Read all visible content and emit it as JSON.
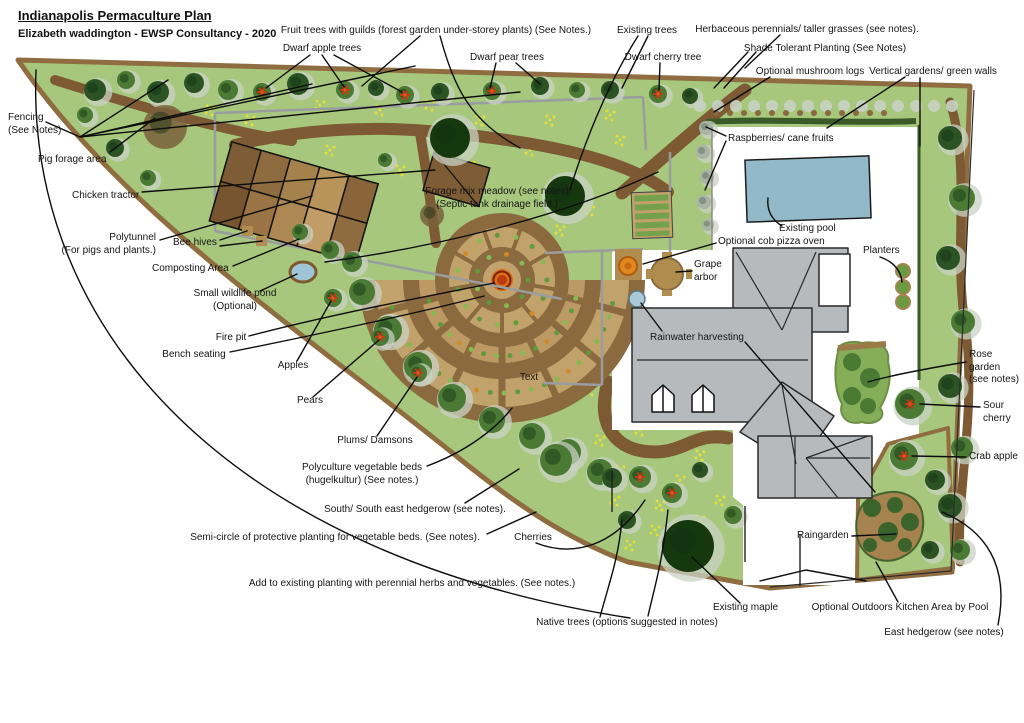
{
  "meta": {
    "title": "Indianapolis Permaculture Plan",
    "subtitle": "Elizabeth waddington - EWSP Consultancy - 2020"
  },
  "colors": {
    "grass": "#a6c77c",
    "meadow_flower": "#e6df38",
    "path_brown": "#7d5a33",
    "boundary_tan": "#8f6d40",
    "pool_blue": "#92b9c7",
    "house_gray": "#b7babd",
    "bed_tan": "#c2a26b",
    "ring_brown": "#8a6a3e",
    "fire_orange": "#d97014",
    "fire_red": "#bb3a0e",
    "tree_dark": "#2b5323",
    "tree_mid": "#4a7a33",
    "maple_green": "#16380f",
    "fluff_gray": "#c9d2c4",
    "fence_gray": "#9a9da0",
    "oven_orange": "#e08a20",
    "water_blue": "#9fc6d6",
    "marker_red": "#c23b12"
  },
  "labels": [
    {
      "id": "fruit-trees-guilds",
      "text": "Fruit trees with guilds (forest garden under-storey plants) (See Notes.)",
      "x": 436,
      "y": 31,
      "align": "c"
    },
    {
      "id": "dwarf-apple-trees",
      "text": "Dwarf apple trees",
      "x": 322,
      "y": 49,
      "align": "c"
    },
    {
      "id": "dwarf-pear-trees",
      "text": "Dwarf pear trees",
      "x": 507,
      "y": 58,
      "align": "c"
    },
    {
      "id": "existing-trees",
      "text": "Existing trees",
      "x": 647,
      "y": 31,
      "align": "c"
    },
    {
      "id": "dwarf-cherry-tree",
      "text": "Dwarf cherry tree",
      "x": 663,
      "y": 58,
      "align": "c"
    },
    {
      "id": "herbaceous-perennials",
      "text": "Herbaceous perennials/ taller grasses (see notes).",
      "x": 807,
      "y": 30,
      "align": "c"
    },
    {
      "id": "shade-tolerant",
      "text": "Shade Tolerant Planting (See Notes)",
      "x": 825,
      "y": 49,
      "align": "c"
    },
    {
      "id": "mushroom-logs",
      "text": "Optional mushroom logs",
      "x": 810,
      "y": 72,
      "align": "c"
    },
    {
      "id": "vertical-gardens",
      "text": "Vertical gardens/ green walls",
      "x": 933,
      "y": 72,
      "align": "c"
    },
    {
      "id": "fencing",
      "text": "Fencing\n(See Notes)",
      "x": 8,
      "y": 118,
      "align": "l"
    },
    {
      "id": "pig-forage-area",
      "text": "Pig forage area",
      "x": 38,
      "y": 160,
      "align": "l"
    },
    {
      "id": "chicken-tractor",
      "text": "Chicken tractor",
      "x": 72,
      "y": 196,
      "align": "l"
    },
    {
      "id": "polytunnel",
      "text": "Polytunnel\n(For pigs and plants.)",
      "x": 156,
      "y": 238,
      "align": "r"
    },
    {
      "id": "bee-hives",
      "text": "Bee hives",
      "x": 173,
      "y": 243,
      "align": "l"
    },
    {
      "id": "composting-area",
      "text": "Composting Area",
      "x": 152,
      "y": 269,
      "align": "l"
    },
    {
      "id": "small-wildlife-pond",
      "text": "Small wildlife pond\n(Optional)",
      "x": 235,
      "y": 294,
      "align": "c"
    },
    {
      "id": "fire-pit",
      "text": "Fire pit",
      "x": 231,
      "y": 338,
      "align": "c"
    },
    {
      "id": "bench-seating",
      "text": "Bench seating",
      "x": 194,
      "y": 355,
      "align": "c"
    },
    {
      "id": "apples",
      "text": "Apples",
      "x": 293,
      "y": 366,
      "align": "c"
    },
    {
      "id": "pears",
      "text": "Pears",
      "x": 310,
      "y": 401,
      "align": "c"
    },
    {
      "id": "plums-damsons",
      "text": "Plums/ Damsons",
      "x": 375,
      "y": 441,
      "align": "c"
    },
    {
      "id": "polyculture-beds",
      "text": "Polyculture vegetable beds\n(hugelkultur) (See notes.)",
      "x": 362,
      "y": 468,
      "align": "c"
    },
    {
      "id": "south-hedgerow",
      "text": "South/ South east hedgerow (see notes).",
      "x": 415,
      "y": 510,
      "align": "c"
    },
    {
      "id": "semi-circle-planting",
      "text": "Semi-circle of protective planting for vegetable beds. (See notes).",
      "x": 335,
      "y": 538,
      "align": "c"
    },
    {
      "id": "cherries",
      "text": "Cherries",
      "x": 533,
      "y": 538,
      "align": "c"
    },
    {
      "id": "add-to-existing",
      "text": "Add to existing planting with perennial herbs and vegetables. (See notes.)",
      "x": 412,
      "y": 584,
      "align": "c"
    },
    {
      "id": "native-trees",
      "text": "Native trees (options suggested in notes)",
      "x": 627,
      "y": 623,
      "align": "c"
    },
    {
      "id": "forage-meadow",
      "text": "Forage mix meadow (see notes)\n(Septic tank drainage field.)",
      "x": 497,
      "y": 192,
      "align": "c"
    },
    {
      "id": "text-marker",
      "text": "Text",
      "x": 529,
      "y": 378,
      "align": "c"
    },
    {
      "id": "raspberries",
      "text": "Raspberries/ cane fruits",
      "x": 728,
      "y": 139,
      "align": "l"
    },
    {
      "id": "existing-pool",
      "text": "Existing pool",
      "x": 779,
      "y": 229,
      "align": "l"
    },
    {
      "id": "cob-pizza-oven",
      "text": "Optional cob pizza oven",
      "x": 718,
      "y": 242,
      "align": "l"
    },
    {
      "id": "grape-arbor",
      "text": "Grape\narbor",
      "x": 694,
      "y": 265,
      "align": "l"
    },
    {
      "id": "planters",
      "text": "Planters",
      "x": 863,
      "y": 251,
      "align": "l"
    },
    {
      "id": "rainwater-harvesting",
      "text": "Rainwater harvesting",
      "x": 650,
      "y": 338,
      "align": "l"
    },
    {
      "id": "rose-garden",
      "text": "Rose\ngarden\n(see notes)",
      "x": 969,
      "y": 355,
      "align": "l"
    },
    {
      "id": "sour-cherry",
      "text": "Sour\ncherry",
      "x": 983,
      "y": 406,
      "align": "l"
    },
    {
      "id": "crab-apple",
      "text": "Crab apple",
      "x": 969,
      "y": 457,
      "align": "l"
    },
    {
      "id": "raingarden",
      "text": "Raingarden",
      "x": 797,
      "y": 536,
      "align": "l"
    },
    {
      "id": "existing-maple",
      "text": "Existing maple",
      "x": 713,
      "y": 608,
      "align": "l"
    },
    {
      "id": "outdoor-kitchen",
      "text": "Optional Outdoors Kitchen Area by Pool",
      "x": 900,
      "y": 608,
      "align": "c"
    },
    {
      "id": "east-hedgerow",
      "text": "East hedgerow (see notes)",
      "x": 944,
      "y": 633,
      "align": "c"
    }
  ]
}
